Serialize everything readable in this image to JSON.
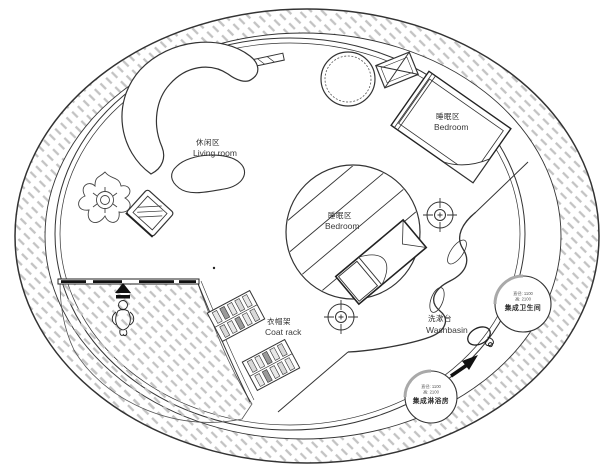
{
  "plan": {
    "zones": {
      "living": {
        "zh": "休闲区",
        "en": "Living room"
      },
      "bedroom_upper": {
        "zh": "睡眠区",
        "en": "Bedroom"
      },
      "bedroom_center": {
        "zh": "睡眠区",
        "en": "Bedroom"
      },
      "coat_rack": {
        "zh": "衣帽架",
        "en": "Coat rack"
      },
      "washbasin": {
        "zh": "洗漱台",
        "en": "Washbasin"
      }
    },
    "pods": {
      "bathroom": {
        "dim1": "直径: 1100",
        "dim2": "高: 2100",
        "zh": "集成卫生间"
      },
      "shower": {
        "dim1": "直径: 1100",
        "dim2": "高: 2100",
        "zh": "集成淋浴房"
      }
    },
    "icons": {
      "entry_arrow": "entry-direction-arrow",
      "person": "person-figure",
      "plant": "potted-plant",
      "round_table": "round-table",
      "crossed_box": "crossed-box-fixture",
      "crosshair": "ceiling-light-target",
      "mirror": "hand-mirror",
      "flow_arrow": "flow-direction-arrow"
    },
    "colors": {
      "line": "#333333",
      "hatch": "#c3c3c3",
      "pod_wall": "#a9a9a9",
      "background": "#ffffff"
    }
  }
}
